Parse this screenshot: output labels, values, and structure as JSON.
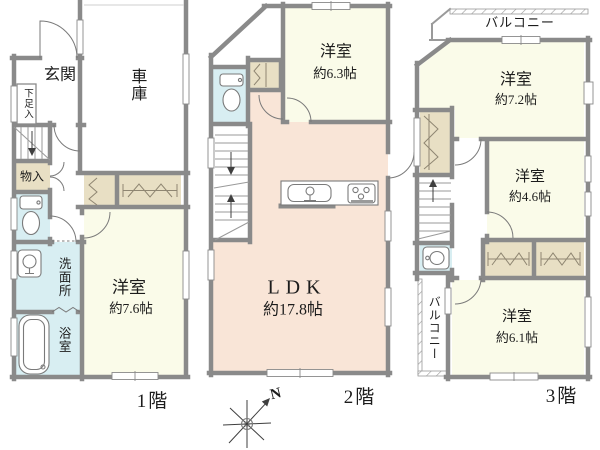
{
  "palette": {
    "paper": "#ffffff",
    "wall": "#8a8a8a",
    "wall_light": "#9a9a9a",
    "line": "#7a7a7a",
    "text": "#1c1c1c",
    "room_cream": "#fafbe9",
    "room_pink": "#f9e5d7",
    "water_blue": "#d8eef2",
    "closet_beige": "#e8dfc4"
  },
  "floors": [
    {
      "label": "1階",
      "rooms": {
        "genkan": "玄関",
        "garage": "車庫",
        "shoe_box": "下足入",
        "storage": "物入",
        "washroom": "洗面所",
        "bathroom": "浴室",
        "bedroom_name": "洋室",
        "bedroom_size": "約7.6帖"
      }
    },
    {
      "label": "2階",
      "rooms": {
        "bedroom_name": "洋室",
        "bedroom_size": "約6.3帖",
        "ldk_name": "LDK",
        "ldk_size": "約17.8帖"
      }
    },
    {
      "label": "3階",
      "rooms": {
        "balcony_top": "バルコニー",
        "bedroom72_name": "洋室",
        "bedroom72_size": "約7.2帖",
        "bedroom46_name": "洋室",
        "bedroom46_size": "約4.6帖",
        "balcony_side": "バルコニー",
        "bedroom61_name": "洋室",
        "bedroom61_size": "約6.1帖"
      }
    }
  ],
  "compass": {
    "north": "N"
  }
}
